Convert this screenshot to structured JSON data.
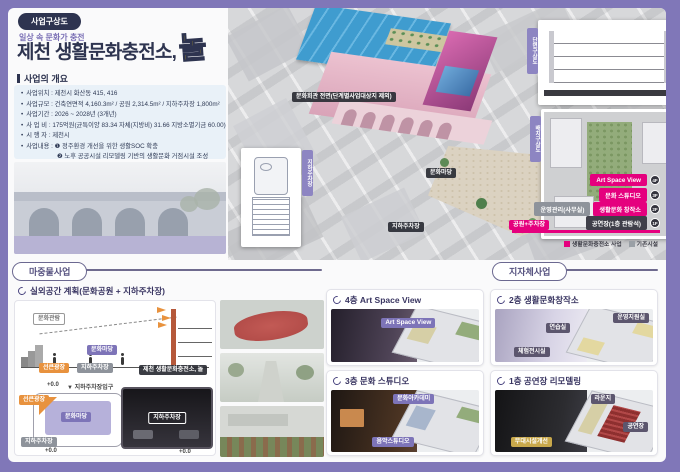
{
  "colors": {
    "accent": "#e5007e",
    "purple": "#7d74b8",
    "navy": "#2e3450",
    "yellow": "#ffd400",
    "frame": "#8077b8"
  },
  "header": {
    "badge": "사업구상도",
    "tagline": "일상 속 문화가 충전",
    "title": "제천 생활문화충전소,",
    "title_accent": "놀"
  },
  "overview": {
    "heading": "사업의 개요",
    "items": [
      "사업위치 : 제천시 화산동 415, 416",
      "사업규모 : 건축연면적 4,160.3m² / 공원 2,314.5m² / 지하주차장 1,800m²",
      "사업기간 : 2026 ~ 2028년 (3개년)",
      "사 업 비 : 175억원(균특이양 83.34 자체(지방비) 31.66 지방소멸기금 60.00)",
      "시 행 자 : 제천시",
      "사업내용 : ❶ 정주환경 개선을 위한 생활SOC 확충",
      "❷ 노후 공공시설 리모델링 기반의 생활문화 거점시설 조성"
    ]
  },
  "aerial": {
    "building_tag": "문화회관 전면(단계별사업대상지 제외)",
    "plaza_tag": "문화마당",
    "parking_tag": "지하주차장",
    "tabs": {
      "section": "단면구상도",
      "siteplan": "배치구상도",
      "floorplan": "지하주차장"
    },
    "floors": [
      {
        "name": "Art Space View",
        "level": "4F"
      },
      {
        "name": "문화 스튜디오",
        "level": "3F"
      },
      {
        "name": "생활문화 창작소",
        "level": "2F",
        "aside": "운영관리(사무실)"
      },
      {
        "name": "공연장(1층 관람석)",
        "level": "1F"
      }
    ],
    "park_bar": "공원+주차장",
    "legend": [
      {
        "label": "생활문화충전소 사업",
        "color": "#e5007e"
      },
      {
        "label": "기존시설",
        "color": "#9aa0a6"
      }
    ]
  },
  "seed": {
    "title": "마중물사업",
    "subtitle": "실외공간 계획(문화공원 + 지하주차장)",
    "section_sketch": {
      "view": "문화관람",
      "plaza": "문화마당",
      "sunken": "선큰광장",
      "parking": "지하주차장",
      "caption": "제천 생활문화충전소, 놀"
    },
    "plan_sketch": {
      "level_top": "+0.0",
      "entry": "▼ 지하주차장입구",
      "sunken": "선큰광장",
      "plaza": "문화마당",
      "parking": "지하주차장",
      "level_left": "+0.0",
      "level_right": "+0.0",
      "photo_tag": "지하주차장"
    },
    "cards": [
      {
        "title": "4층 Art Space View",
        "tag": "Art Space View"
      },
      {
        "title": "3층 문화 스튜디오",
        "tag_top": "문화아카데미",
        "tag_bottom": "음악스튜디오"
      }
    ]
  },
  "gov": {
    "title": "지자체사업",
    "cards": [
      {
        "title": "2층 생활문화창작소",
        "tags": [
          "운영지원실",
          "연습실",
          "체험전시실"
        ]
      },
      {
        "title": "1층 공연장 리모델링",
        "tags": [
          "라운지",
          "공연장",
          "무대시설개선"
        ]
      }
    ]
  }
}
